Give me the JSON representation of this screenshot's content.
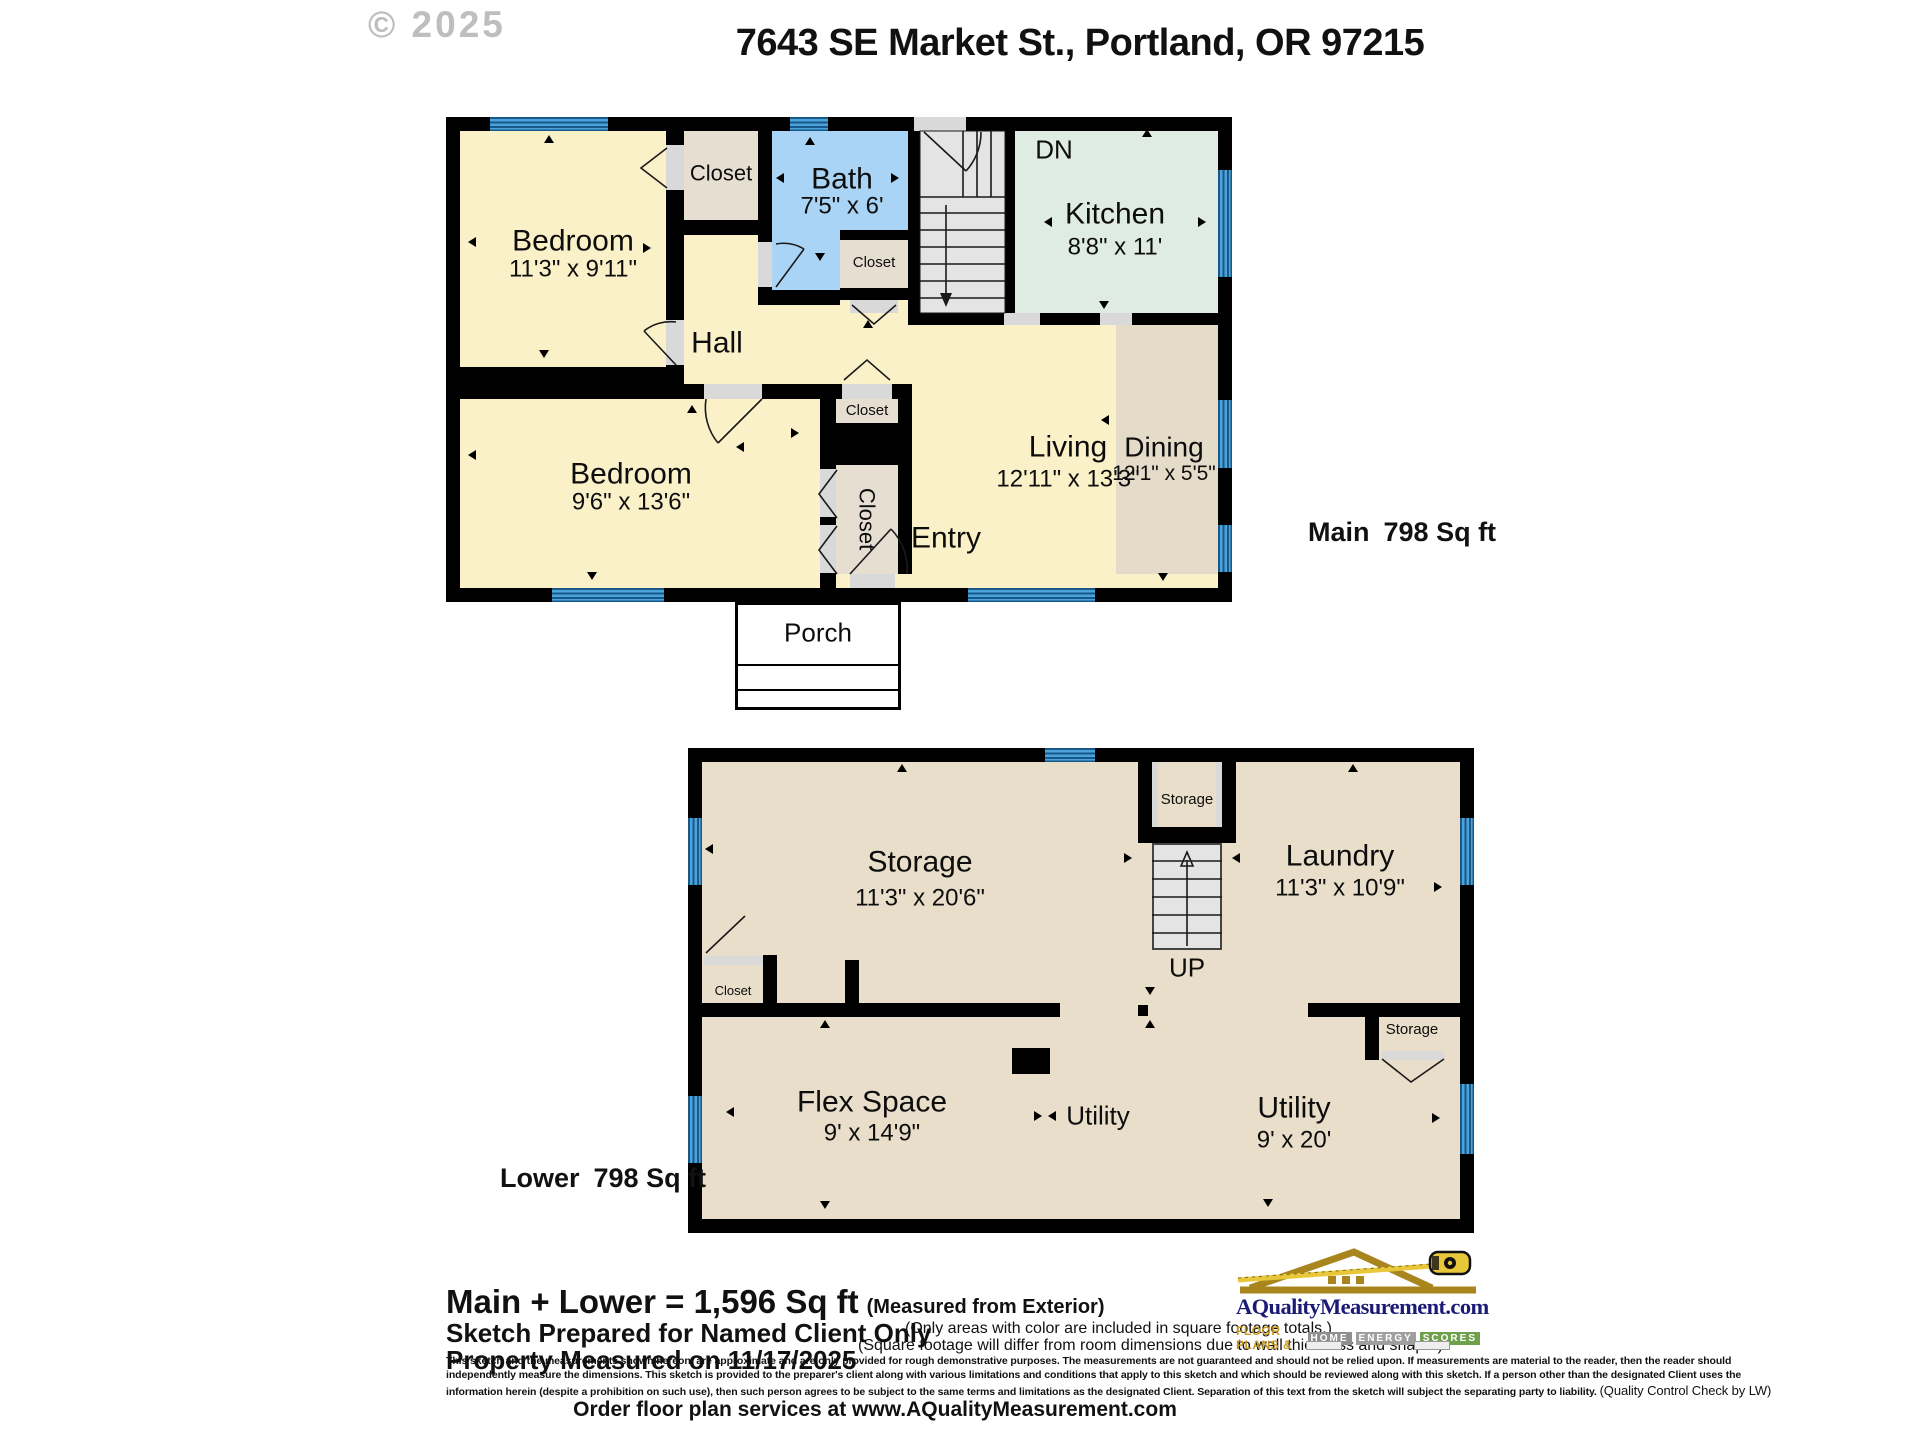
{
  "watermark": "© 2025",
  "title": "7643 SE Market St., Portland, OR 97215",
  "common": {
    "closet": "Closet",
    "storage": "Storage"
  },
  "main_floor": {
    "area_floor": "Main",
    "area_sqft": "798 Sq ft",
    "bedroom1": {
      "name": "Bedroom",
      "dims": "11'3\" x 9'11\""
    },
    "bedroom2": {
      "name": "Bedroom",
      "dims": "9'6\" x 13'6\""
    },
    "bath": {
      "name": "Bath",
      "dims": "7'5\" x 6'"
    },
    "kitchen": {
      "name": "Kitchen",
      "dims": "8'8\" x 11'"
    },
    "living": {
      "name": "Living",
      "dims": "12'11\" x 13'3\""
    },
    "dining": {
      "name": "Dining",
      "dims": "12'1\" x 5'5\""
    },
    "hall": "Hall",
    "entry": "Entry",
    "porch": "Porch",
    "stairs_down": "DN"
  },
  "lower_floor": {
    "area_floor": "Lower",
    "area_sqft": "798 Sq ft",
    "storage": {
      "name": "Storage",
      "dims": "11'3\" x 20'6\""
    },
    "laundry": {
      "name": "Laundry",
      "dims": "11'3\" x 10'9\""
    },
    "flex": {
      "name": "Flex Space",
      "dims": "9' x 14'9\""
    },
    "utility_large": {
      "name": "Utility",
      "dims": "9' x 20'"
    },
    "utility_small": "Utility",
    "stairs_up": "UP"
  },
  "footer": {
    "total": "Main + Lower = 1,596 Sq ft",
    "total_note": "(Measured from Exterior)",
    "prepared": "Sketch Prepared for Named Client Only",
    "measured": "Property Measured on 11/17/2025",
    "color_note": "(Only areas with color are included in square footage totals.)",
    "sqft_note": "(Square footage will differ from room dimensions due to wall thickness and shape.)",
    "disclaimer1": "This sketch and the measurements shown hereon, are approximate and are only provided for rough demonstrative purposes.  The measurements are not guaranteed and should not be relied upon.  If measurements are material to the reader, then the reader should",
    "disclaimer2": "independently measure the dimensions.  This sketch is provided to the preparer's client along with various limitations and conditions that apply to this sketch and which should be reviewed along with this sketch.  If a person other than the designated Client uses the",
    "disclaimer3": "information herein (despite a prohibition on such use), then such person agrees to be subject to the same terms and limitations as the designated Client.  Separation of this text from the sketch will subject the separating party to liability. ",
    "qc_note": "(Quality Control Check by LW)",
    "order": "Order floor plan services at www.AQualityMeasurement.com"
  },
  "logo": {
    "site": "AQualityMeasurement.com",
    "tagline": "FLOOR PLANS &",
    "badge1": "HOME",
    "badge2": "ENERGY",
    "badge3": "SCORES"
  }
}
